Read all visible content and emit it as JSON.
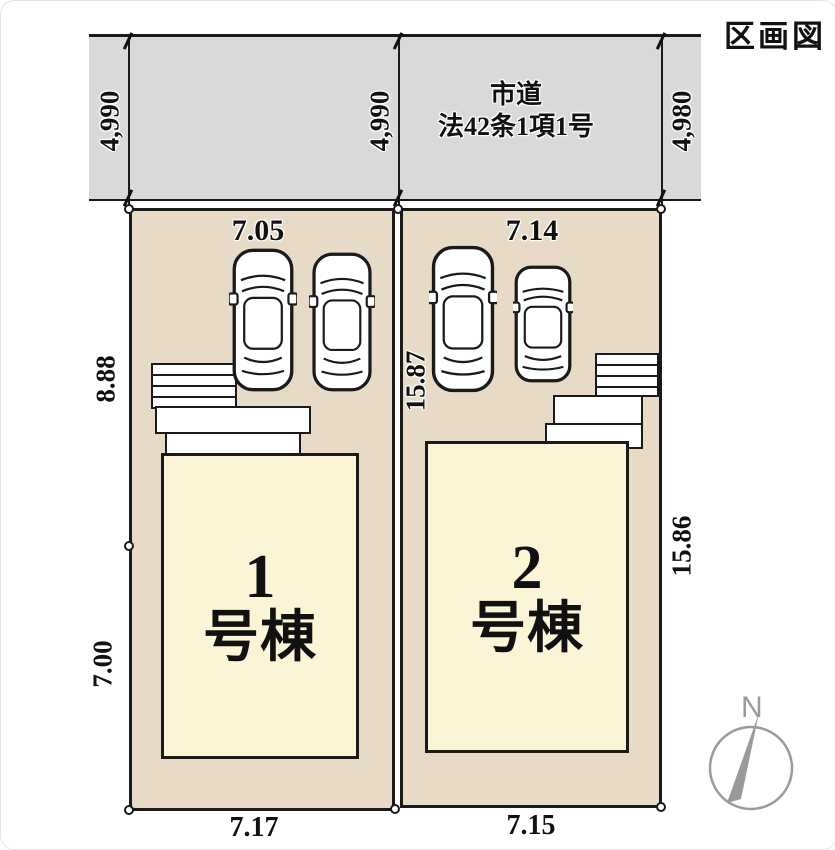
{
  "title": "区画図",
  "road": {
    "name_line1": "市道",
    "name_line2": "法42条1項1号",
    "dims": {
      "left": "4,990",
      "middle": "4,990",
      "right": "4,980"
    }
  },
  "lots": [
    {
      "label_number": "1",
      "label_suffix": "号棟",
      "dim_top": "7.05",
      "dim_bottom": "7.17",
      "dim_side_upper": "8.88",
      "dim_side_lower": "7.00"
    },
    {
      "label_number": "2",
      "label_suffix": "号棟",
      "dim_top": "7.14",
      "dim_bottom": "7.15",
      "dim_side_left": "15.87",
      "dim_side_right": "15.86"
    }
  ],
  "compass": {
    "north_label": "N"
  },
  "colors": {
    "road_fill": "#d8d9db",
    "lot_fill": "#e7dbc7",
    "building_fill": "#fbf4d7",
    "line": "#1a1a1a",
    "compass": "#9a9a9a"
  }
}
